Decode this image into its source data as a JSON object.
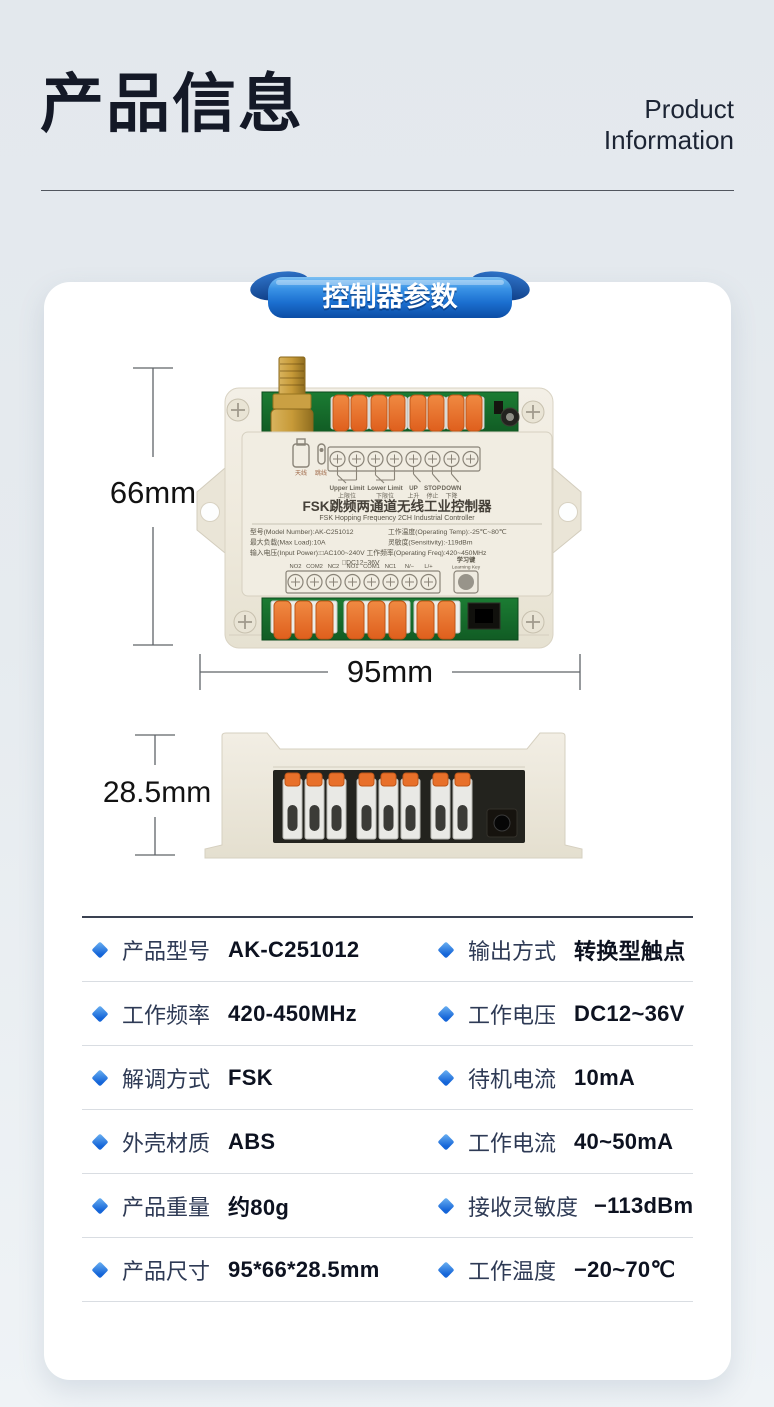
{
  "header": {
    "title": "产品信息",
    "subtitle_line1": "Product",
    "subtitle_line2": "Information"
  },
  "badge": {
    "label": "控制器参数"
  },
  "dimensions": {
    "height": "66mm",
    "width": "95mm",
    "depth": "28.5mm"
  },
  "device": {
    "front": {
      "title_cn": "FSK跳频两通道无线工业控制器",
      "title_en": "FSK Hopping Frequency 2CH Industrial Controller",
      "antenna_icon_label": "天线",
      "jumper_icon_label": "跳线",
      "diagram_labels": [
        {
          "en": "Upper Limit",
          "cn": "上限位"
        },
        {
          "en": "Lower Limit",
          "cn": "下限位"
        },
        {
          "en": "UP",
          "cn": "上升"
        },
        {
          "en": "STOP",
          "cn": "停止"
        },
        {
          "en": "DOWN",
          "cn": "下降"
        }
      ],
      "spec_lines": {
        "model": "型号(Model Number):AK-C251012",
        "operating_temp": "工作温度(Operating Temp):-25℃~80℃",
        "max_load": "最大负载(Max Load):10A",
        "sensitivity": "灵敏度(Sensitivity):-119dBm",
        "input_power": "输入电压(Input Power):□AC100~240V 工作频率(Operating Freq):420~450MHz",
        "input_power2": "□DC12~36V"
      },
      "terminals": [
        "NO2",
        "COM2",
        "NC2",
        "NO1",
        "COM1",
        "NC1",
        "N/−",
        "L/+"
      ],
      "learning_key_cn": "学习键",
      "learning_key_en": "Learning Key"
    }
  },
  "specs": {
    "rows": [
      {
        "l_label": "产品型号",
        "l_value": "AK-C251012",
        "r_label": "输出方式",
        "r_value": "转换型触点"
      },
      {
        "l_label": "工作频率",
        "l_value": "420-450MHz",
        "r_label": "工作电压",
        "r_value": "DC12~36V"
      },
      {
        "l_label": "解调方式",
        "l_value": "FSK",
        "r_label": "待机电流",
        "r_value": "10mA"
      },
      {
        "l_label": "外壳材质",
        "l_value": "ABS",
        "r_label": "工作电流",
        "r_value": "40~50mA"
      },
      {
        "l_label": "产品重量",
        "l_value": "约80g",
        "r_label": "接收灵敏度",
        "r_value": "−113dBm"
      },
      {
        "l_label": "产品尺寸",
        "l_value": "95*66*28.5mm",
        "r_label": "工作温度",
        "r_value": "−20~70℃"
      }
    ]
  },
  "colors": {
    "accent_blue": "#1e7ae0",
    "ribbon_dark": "#0c4da5",
    "diamond_blue": "#1e88e5",
    "pcb_green": "#15682a",
    "lever_orange": "#ea722c",
    "case_cream": "#efeadd"
  }
}
